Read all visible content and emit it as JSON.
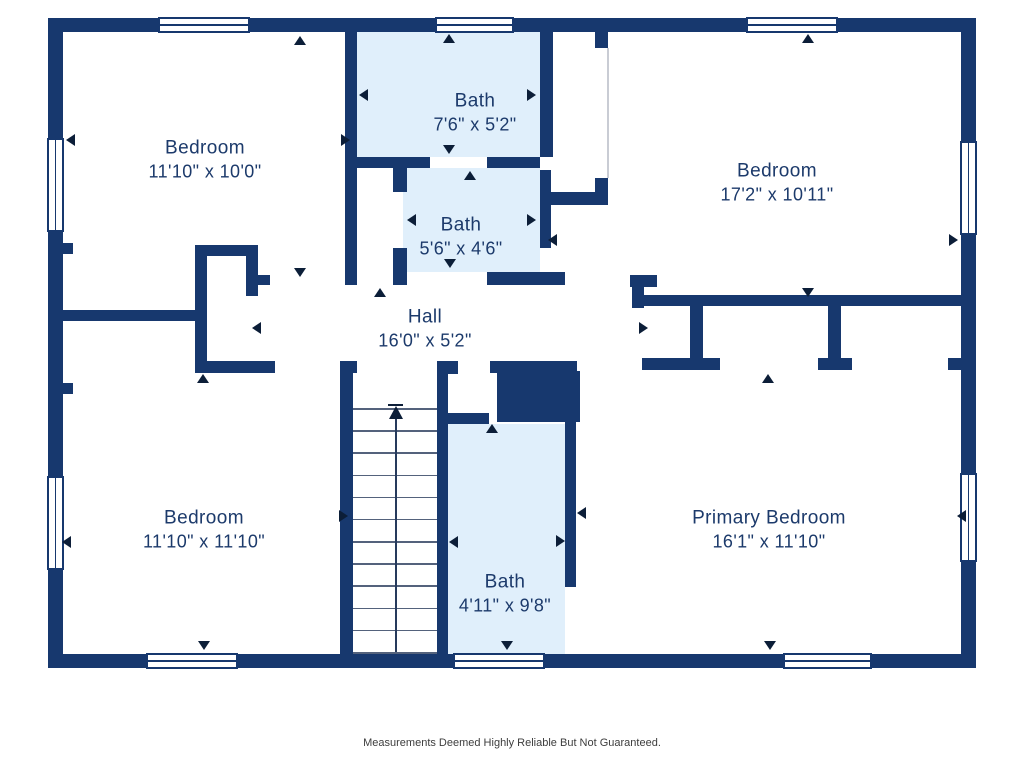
{
  "disclaimer": "Measurements Deemed Highly Reliable But Not Guaranteed.",
  "colors": {
    "wall": "#17386e",
    "bath_floor": "#e0effb",
    "room_floor": "#ffffff",
    "label_text": "#1c3a6b",
    "door_arrow": "#0c1e38",
    "stair_tread": "#54627c",
    "disclaimer_text": "#3d3d3d"
  },
  "rooms": [
    {
      "name": "Bedroom",
      "dims": "11'10\" x 10'0\"",
      "x": 205,
      "y": 160
    },
    {
      "name": "Bath",
      "dims": "7'6\" x 5'2\"",
      "x": 475,
      "y": 113
    },
    {
      "name": "Bath",
      "dims": "5'6\" x 4'6\"",
      "x": 461,
      "y": 237
    },
    {
      "name": "Bedroom",
      "dims": "17'2\" x 10'11\"",
      "x": 777,
      "y": 183
    },
    {
      "name": "Hall",
      "dims": "16'0\" x 5'2\"",
      "x": 425,
      "y": 329
    },
    {
      "name": "Bedroom",
      "dims": "11'10\" x 11'10\"",
      "x": 204,
      "y": 530
    },
    {
      "name": "Bath",
      "dims": "4'11\" x 9'8\"",
      "x": 505,
      "y": 594
    },
    {
      "name": "Primary Bedroom",
      "dims": "16'1\" x 11'10\"",
      "x": 769,
      "y": 530
    }
  ],
  "plan": {
    "bath_fills": [
      [
        357,
        32,
        183,
        125
      ],
      [
        403,
        168,
        137,
        104
      ],
      [
        447,
        424,
        118,
        230
      ]
    ],
    "walls": [
      [
        48,
        18,
        110,
        14
      ],
      [
        250,
        18,
        185,
        14
      ],
      [
        514,
        18,
        232,
        14
      ],
      [
        838,
        18,
        138,
        14
      ],
      [
        48,
        654,
        98,
        14
      ],
      [
        238,
        654,
        215,
        14
      ],
      [
        545,
        654,
        238,
        14
      ],
      [
        872,
        654,
        104,
        14
      ],
      [
        48,
        32,
        15,
        106
      ],
      [
        48,
        232,
        15,
        244
      ],
      [
        48,
        570,
        15,
        84
      ],
      [
        961,
        32,
        15,
        109
      ],
      [
        961,
        235,
        15,
        238
      ],
      [
        961,
        562,
        15,
        92
      ],
      [
        345,
        32,
        12,
        253
      ],
      [
        357,
        157,
        46,
        11
      ],
      [
        403,
        157,
        27,
        11
      ],
      [
        487,
        157,
        53,
        11
      ],
      [
        540,
        32,
        13,
        125
      ],
      [
        540,
        170,
        11,
        78
      ],
      [
        393,
        168,
        14,
        24
      ],
      [
        393,
        248,
        14,
        24
      ],
      [
        393,
        272,
        14,
        13
      ],
      [
        487,
        272,
        78,
        13
      ],
      [
        195,
        245,
        63,
        11
      ],
      [
        195,
        245,
        12,
        128
      ],
      [
        195,
        361,
        80,
        12
      ],
      [
        246,
        256,
        12,
        40
      ],
      [
        258,
        275,
        12,
        10
      ],
      [
        63,
        243,
        10,
        11
      ],
      [
        63,
        310,
        132,
        11
      ],
      [
        63,
        383,
        10,
        11
      ],
      [
        595,
        32,
        13,
        16
      ],
      [
        595,
        178,
        13,
        27
      ],
      [
        550,
        192,
        58,
        13
      ],
      [
        630,
        275,
        27,
        12
      ],
      [
        632,
        275,
        12,
        33
      ],
      [
        643,
        295,
        318,
        11
      ],
      [
        690,
        306,
        13,
        52
      ],
      [
        828,
        306,
        13,
        52
      ],
      [
        642,
        358,
        78,
        12
      ],
      [
        818,
        358,
        34,
        12
      ],
      [
        948,
        358,
        28,
        12
      ],
      [
        340,
        361,
        13,
        293
      ],
      [
        340,
        361,
        17,
        12
      ],
      [
        437,
        361,
        11,
        293
      ],
      [
        437,
        361,
        21,
        13
      ],
      [
        447,
        413,
        42,
        11
      ],
      [
        490,
        361,
        87,
        12
      ],
      [
        565,
        371,
        11,
        216
      ]
    ],
    "solids": [
      [
        497,
        371,
        83,
        51
      ]
    ],
    "windows": [
      {
        "x": 158,
        "y": 17,
        "w": 92,
        "h": 16,
        "o": "h"
      },
      {
        "x": 435,
        "y": 17,
        "w": 79,
        "h": 16,
        "o": "h"
      },
      {
        "x": 746,
        "y": 17,
        "w": 92,
        "h": 16,
        "o": "h"
      },
      {
        "x": 146,
        "y": 653,
        "w": 92,
        "h": 16,
        "o": "h"
      },
      {
        "x": 453,
        "y": 653,
        "w": 92,
        "h": 16,
        "o": "h"
      },
      {
        "x": 783,
        "y": 653,
        "w": 89,
        "h": 16,
        "o": "h"
      },
      {
        "x": 47,
        "y": 138,
        "w": 17,
        "h": 94,
        "o": "v"
      },
      {
        "x": 47,
        "y": 476,
        "w": 17,
        "h": 94,
        "o": "v"
      },
      {
        "x": 960,
        "y": 141,
        "w": 17,
        "h": 94,
        "o": "v"
      },
      {
        "x": 960,
        "y": 473,
        "w": 17,
        "h": 89,
        "o": "v"
      }
    ],
    "faint_lines": [
      [
        607,
        48,
        1.5,
        130
      ]
    ],
    "arrows": [
      {
        "x": 300,
        "y": 36,
        "d": "up"
      },
      {
        "x": 449,
        "y": 34,
        "d": "up"
      },
      {
        "x": 808,
        "y": 34,
        "d": "up"
      },
      {
        "x": 66,
        "y": 140,
        "d": "left"
      },
      {
        "x": 350,
        "y": 140,
        "d": "right"
      },
      {
        "x": 359,
        "y": 95,
        "d": "left"
      },
      {
        "x": 536,
        "y": 95,
        "d": "right"
      },
      {
        "x": 449,
        "y": 154,
        "d": "down"
      },
      {
        "x": 470,
        "y": 171,
        "d": "up"
      },
      {
        "x": 407,
        "y": 220,
        "d": "left"
      },
      {
        "x": 536,
        "y": 220,
        "d": "right"
      },
      {
        "x": 450,
        "y": 268,
        "d": "down"
      },
      {
        "x": 380,
        "y": 288,
        "d": "up"
      },
      {
        "x": 300,
        "y": 277,
        "d": "down"
      },
      {
        "x": 252,
        "y": 328,
        "d": "left"
      },
      {
        "x": 648,
        "y": 328,
        "d": "right"
      },
      {
        "x": 548,
        "y": 240,
        "d": "left"
      },
      {
        "x": 958,
        "y": 240,
        "d": "right"
      },
      {
        "x": 808,
        "y": 297,
        "d": "down"
      },
      {
        "x": 768,
        "y": 374,
        "d": "up"
      },
      {
        "x": 203,
        "y": 374,
        "d": "up"
      },
      {
        "x": 62,
        "y": 542,
        "d": "left"
      },
      {
        "x": 348,
        "y": 516,
        "d": "right"
      },
      {
        "x": 204,
        "y": 650,
        "d": "down"
      },
      {
        "x": 492,
        "y": 424,
        "d": "up"
      },
      {
        "x": 449,
        "y": 542,
        "d": "left"
      },
      {
        "x": 565,
        "y": 541,
        "d": "right"
      },
      {
        "x": 577,
        "y": 513,
        "d": "left"
      },
      {
        "x": 507,
        "y": 650,
        "d": "down"
      },
      {
        "x": 957,
        "y": 516,
        "d": "left"
      },
      {
        "x": 770,
        "y": 650,
        "d": "down"
      }
    ],
    "stairs": {
      "x_left": 353,
      "x_right": 437,
      "y_top": 408,
      "y_bottom": 652,
      "tread_count": 12,
      "center_x": 395
    }
  }
}
